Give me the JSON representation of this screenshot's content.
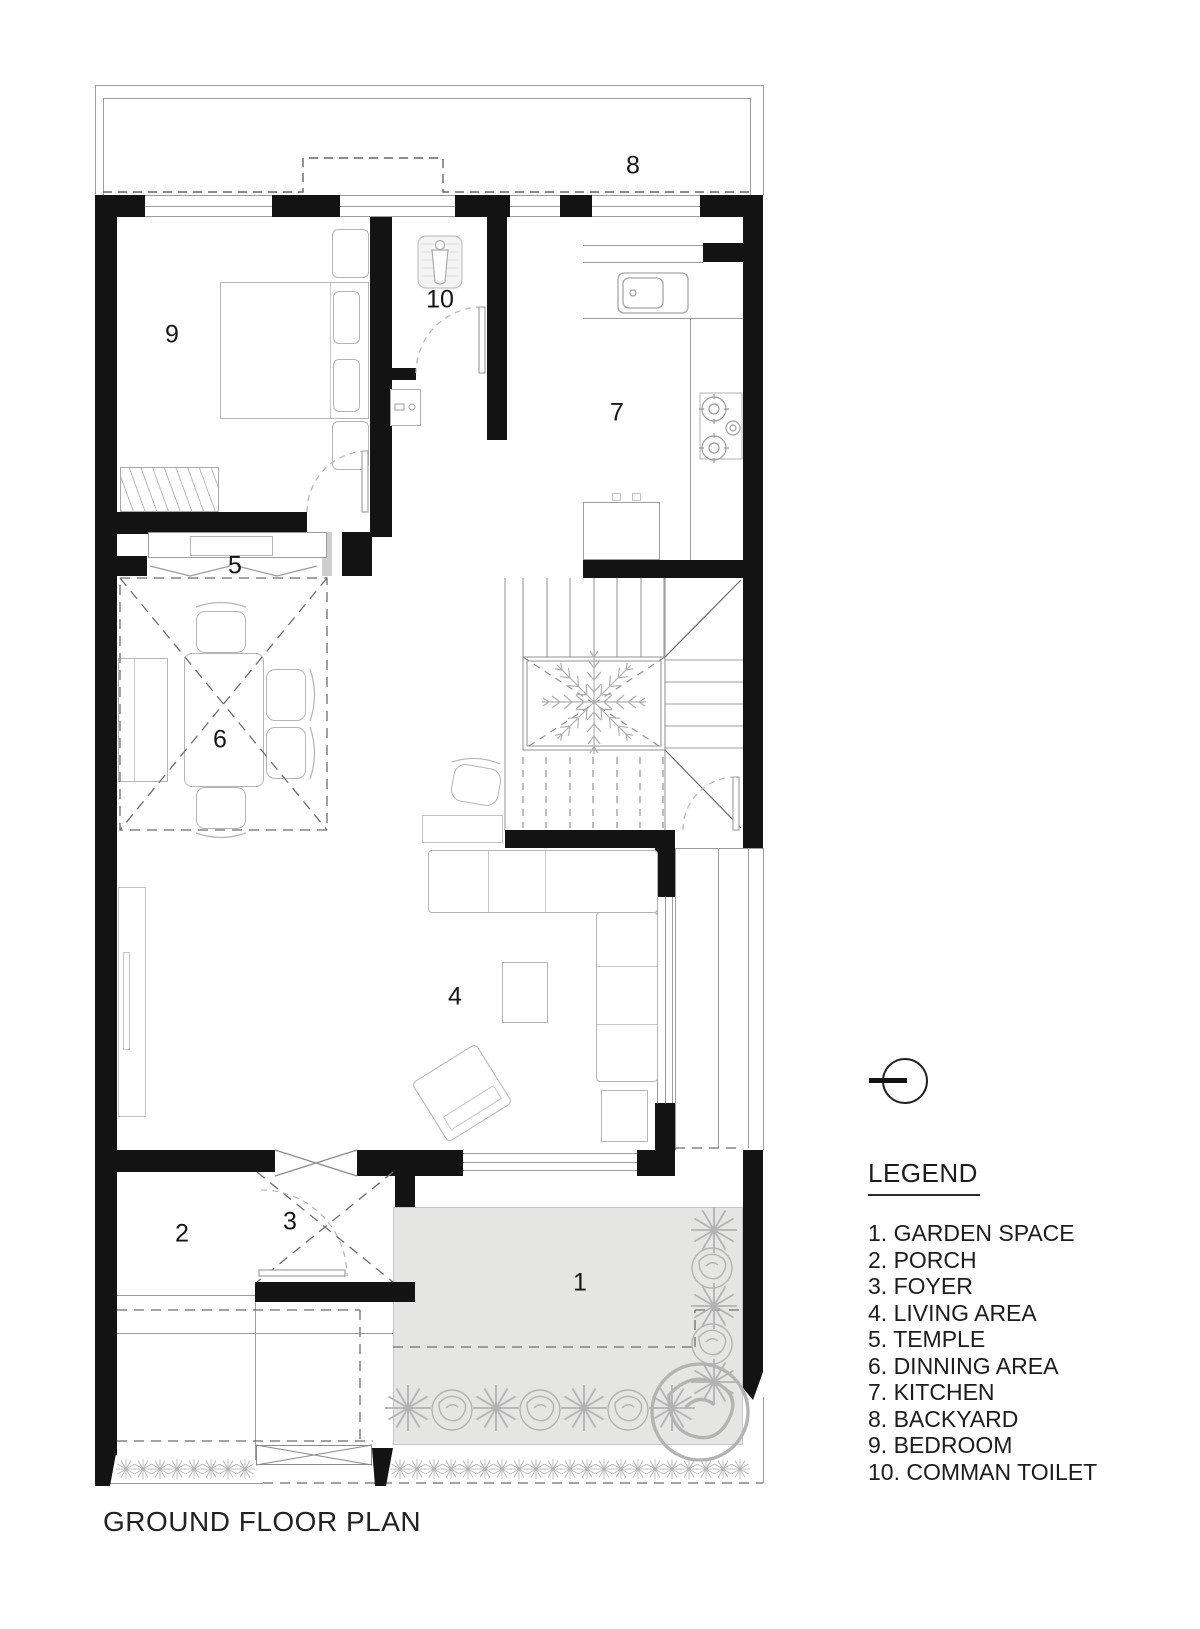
{
  "title": "GROUND FLOOR PLAN",
  "legend": {
    "heading": "LEGEND",
    "items": [
      "1. GARDEN SPACE",
      "2. PORCH",
      "3. FOYER",
      "4. LIVING AREA",
      "5. TEMPLE",
      "6. DINNING AREA",
      "7. KITCHEN",
      "8. BACKYARD",
      "9. BEDROOM",
      "10. COMMAN TOILET"
    ]
  },
  "plan": {
    "labels": {
      "garden": "1",
      "porch": "2",
      "foyer": "3",
      "living": "4",
      "temple": "5",
      "dining": "6",
      "kitchen": "7",
      "backyard": "8",
      "bedroom": "9",
      "toilet": "10"
    }
  },
  "colors": {
    "wall": "#131313",
    "thin_line": "#9c9c9c",
    "furniture_line": "#b5b5b5",
    "garden_fill": "#e5e5e3",
    "plant": "#b3b3b3"
  }
}
